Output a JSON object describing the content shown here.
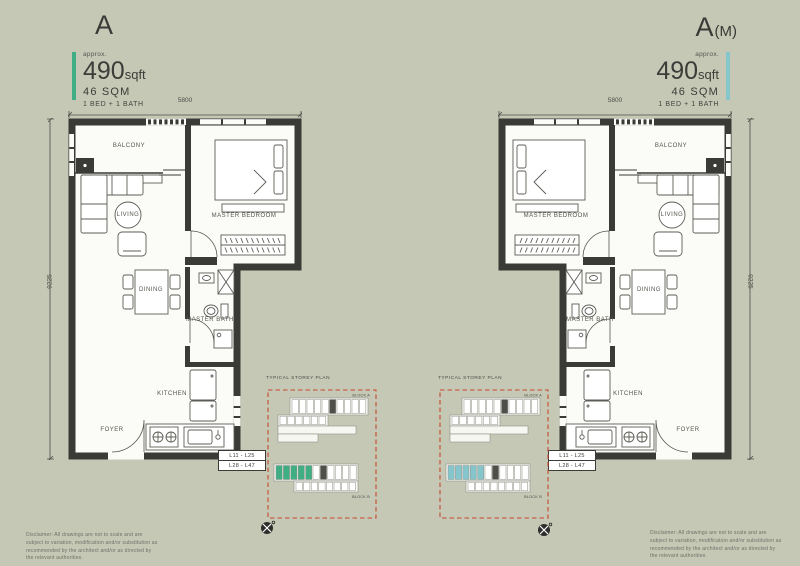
{
  "sheet": {
    "bg": "#c5c8b5",
    "disclaimer": "Disclaimer: All drawings are not to scale and are subject to variation, modification and/or substitution as recommended by the architect and/or as directed by the relevant authorities."
  },
  "rooms": {
    "balcony": "BALCONY",
    "living": "LIVING",
    "master_bedroom": "MASTER BEDROOM",
    "dining": "DINING",
    "master_bath": "MASTER BATH",
    "kitchen": "KITCHEN",
    "foyer": "FOYER"
  },
  "units": [
    {
      "name": "A",
      "suffix": "",
      "approx": "approx.",
      "area_value": "490",
      "area_unit": "sqft",
      "area_sqm": "46 SQM",
      "layout": "1 BED + 1 BATH",
      "accent": "#3fae85",
      "dim_width": "5800",
      "dim_height": "9225",
      "levels_line1": "L11 - L25",
      "levels_line2": "L28 - L47"
    },
    {
      "name": "A",
      "suffix": "(M)",
      "approx": "approx.",
      "area_value": "490",
      "area_unit": "sqft",
      "area_sqm": "46 SQM",
      "layout": "1 BED + 1 BATH",
      "accent": "#85c6cd",
      "dim_width": "5800",
      "dim_height": "9225",
      "levels_line1": "L11 - L25",
      "levels_line2": "L28 - L47"
    }
  ],
  "inset": {
    "title": "TYPICAL STOREY PLAN",
    "block_top": "BLOCK A",
    "block_bottom": "BLOCK B"
  }
}
